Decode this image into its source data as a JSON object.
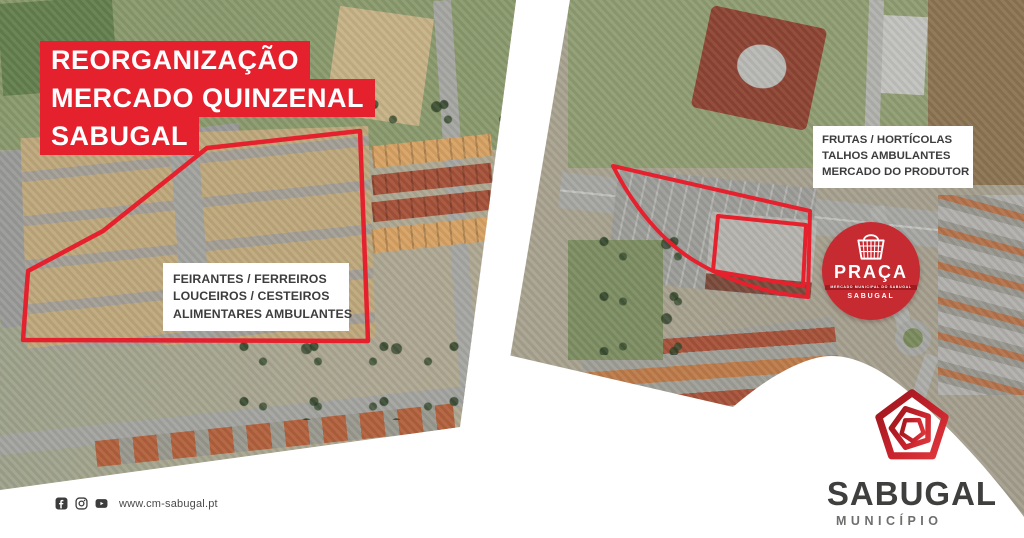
{
  "title": {
    "lines": [
      "REORGANIZAÇÃO",
      "MERCADO QUINZENAL",
      "SABUGAL"
    ]
  },
  "left_map": {
    "label_lines": [
      "FEIRANTES / FERREIROS",
      "LOUCEIROS / CESTEIROS",
      "ALIMENTARES AMBULANTES"
    ]
  },
  "right_map": {
    "label_lines": [
      "FRUTAS / HORTÍCOLAS",
      "TALHOS AMBULANTES",
      "MERCADO DO PRODUTOR"
    ]
  },
  "praca_badge": {
    "title": "PRAÇA",
    "ribbon_text": "MERCADO MUNICIPAL DO SABUGAL",
    "subtitle": "SABUGAL",
    "icon": "shopping-basket-icon"
  },
  "municipality_logo": {
    "name": "SABUGAL",
    "subtitle": "MUNICÍPIO",
    "icon": "pentagon-spiral-icon"
  },
  "footer": {
    "website": "www.cm-sabugal.pt",
    "social_icons": [
      "facebook-icon",
      "instagram-icon",
      "youtube-icon"
    ]
  },
  "colors": {
    "accent_red": "#e6212e",
    "badge_red": "#c62b32",
    "ribbon_red": "#9e1b22",
    "logo_red_dark": "#99151b",
    "logo_red_bright": "#e0393f",
    "label_text": "#3d3d3d",
    "logo_text": "#3f3f3d"
  }
}
